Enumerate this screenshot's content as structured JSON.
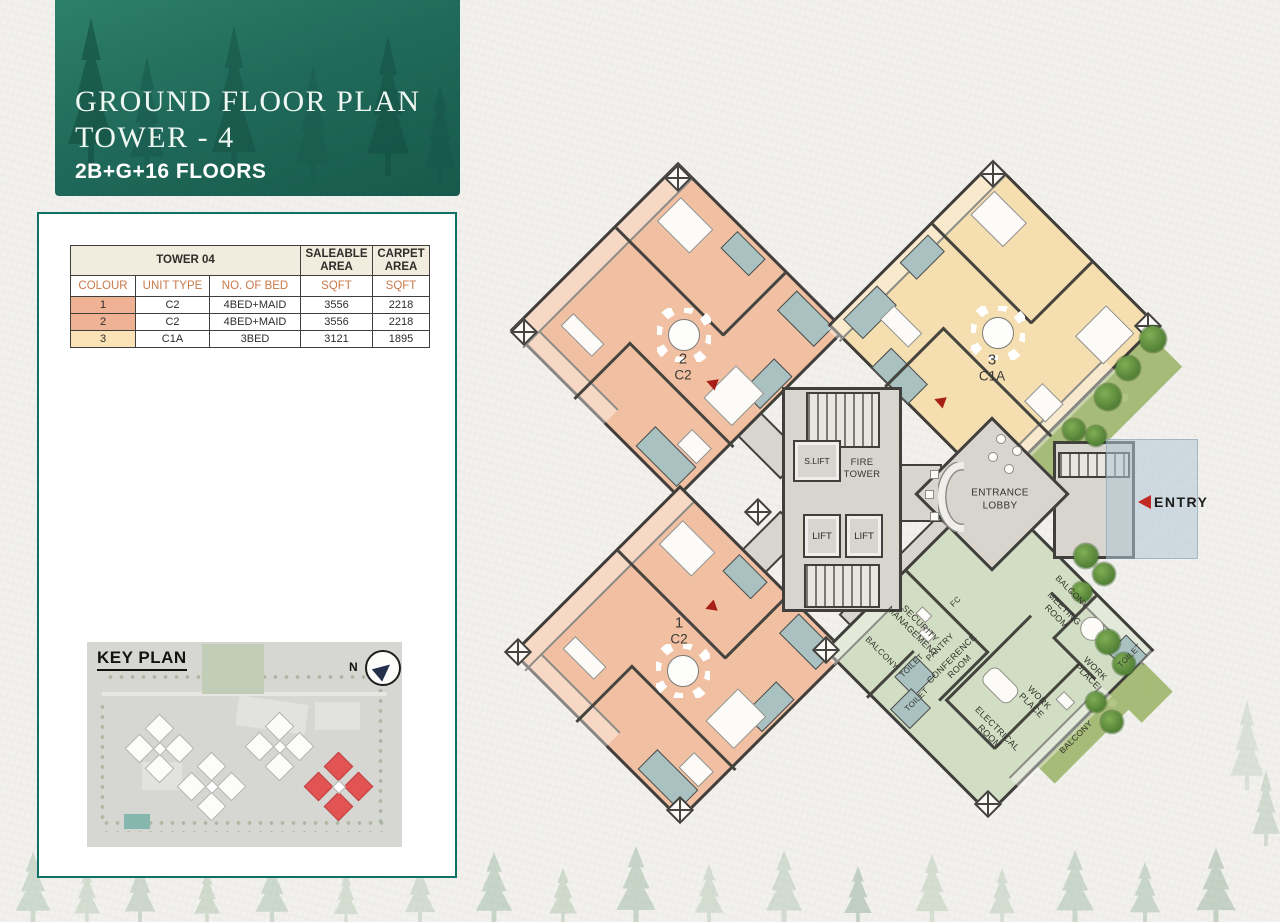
{
  "header": {
    "title_line1": "GROUND FLOOR PLAN",
    "title_line2": "TOWER - 4",
    "subtitle": "2B+G+16 FLOORS",
    "bg_color": "#20695a"
  },
  "spec_table": {
    "title": "TOWER 04",
    "saleable_header": "SALEABLE\nAREA",
    "carpet_header": "CARPET\nAREA",
    "columns": [
      "COLOUR",
      "UNIT TYPE",
      "NO. OF BED",
      "SQFT",
      "SQFT"
    ],
    "header_text_color": "#c9794a",
    "rows": [
      {
        "colour": "1",
        "unit_type": "C2",
        "no_of_bed": "4BED+MAID",
        "saleable_sqft": "3556",
        "carpet_sqft": "2218",
        "swatch": "#f0b294"
      },
      {
        "colour": "2",
        "unit_type": "C2",
        "no_of_bed": "4BED+MAID",
        "saleable_sqft": "3556",
        "carpet_sqft": "2218",
        "swatch": "#f0b294"
      },
      {
        "colour": "3",
        "unit_type": "C1A",
        "no_of_bed": "3BED",
        "saleable_sqft": "3121",
        "carpet_sqft": "1895",
        "swatch": "#fbe2b7"
      }
    ]
  },
  "key_plan": {
    "title": "KEY PLAN",
    "north_label": "N",
    "highlight_color": "#e25454"
  },
  "floor_plan": {
    "units": [
      {
        "number": "1",
        "type": "C2",
        "fill": "#f1c0a2"
      },
      {
        "number": "2",
        "type": "C2",
        "fill": "#f1c0a2"
      },
      {
        "number": "3",
        "type": "C1A",
        "fill": "#f5deb0"
      }
    ],
    "amenity_fill": "#d2dec3",
    "core": {
      "s_lift": "S.LIFT",
      "fire_tower": "FIRE\nTOWER",
      "lift_left": "LIFT",
      "lift_right": "LIFT",
      "entrance_lobby": "ENTRANCE\nLOBBY"
    },
    "entry_label": "ENTRY",
    "amenity_rooms": [
      "SECURITY\nMANAGEMENT",
      "FC",
      "BALCONY",
      "PANTRY",
      "TOILET",
      "TOILET",
      "CONFERENCE\nROOM",
      "MEETING\nROOM",
      "BALCONY",
      "WORK\nPLACE",
      "WORK\nPLACE",
      "TOILET",
      "ELECTRICAL\nROOM",
      "BALCONY"
    ]
  }
}
